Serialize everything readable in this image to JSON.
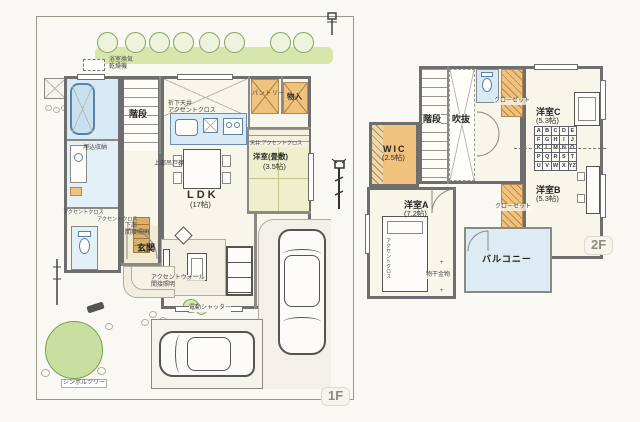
{
  "document": {
    "type": "house-floor-plan",
    "floor_tags": [
      "1F",
      "2F"
    ]
  },
  "colors": {
    "wall": "#6e6e6e",
    "water_blue": "#d8eaf5",
    "closet_orange": "#f0c27e",
    "tatami_green": "#eef0cb",
    "greenery": "#cfe3a8",
    "balcony_blue": "#dcebf4",
    "paper": "#faf8f2"
  },
  "floor1": {
    "floor_tag": "1F",
    "labels": {
      "bath_vent": "浴室換気\n乾燥機",
      "stairs": "階段",
      "dropped_ceiling": "折下天井\nアクセントクロス",
      "pantry": "パントリー",
      "storage": "物入",
      "tatami_ceiling": "天井:アクセントクロス",
      "tatami_room": "洋室(畳敷)",
      "tatami_size": "(3.5帖)",
      "ldk": "LDK",
      "ldk_size": "(17帖)",
      "upper_cabinet": "上部吊戸棚",
      "recessed_storage": "埋込収納",
      "accent_cloth_wash": "アクセントクロス",
      "accent_cloth_hall": "アクセントクロス",
      "entrance_lower_lighting": "下部\n間接照明",
      "entrance": "玄関",
      "accent_wall_lighting": "アクセントウォール\n間接照明",
      "electric_shutter": "電動シャッター",
      "symbol_tree": "シンボルツリー"
    }
  },
  "floor2": {
    "floor_tag": "2F",
    "labels": {
      "stairs": "階段",
      "void": "吹抜",
      "closet_top": "クローゼット",
      "closet_bottom": "クローゼット",
      "room_c": "洋室C",
      "room_c_size": "(5.3帖)",
      "wic": "WIC",
      "wic_size": "(2.5帖)",
      "room_a": "洋室A",
      "room_a_size": "(7.2帖)",
      "room_b": "洋室B",
      "room_b_size": "(5.3帖)",
      "balcony": "バルコニー",
      "laundry_hardware": "物干金物",
      "accent_cloth": "アクセントクロス"
    },
    "alphabet_rows": [
      "ABCDE",
      "FGHIJ",
      "KLMNO",
      "PQRST",
      "UVWXYZ"
    ]
  }
}
